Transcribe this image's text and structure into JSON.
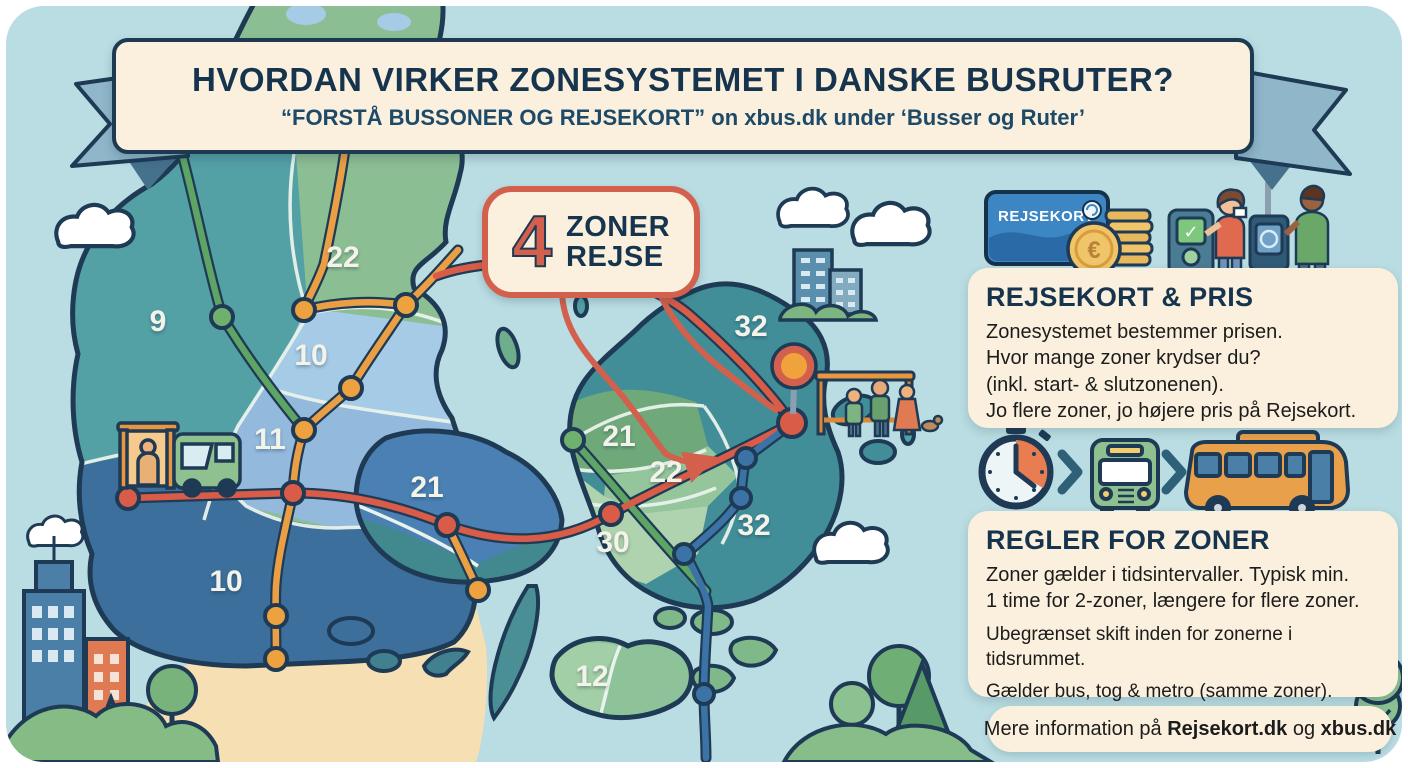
{
  "banner": {
    "title": "HVORDAN VIRKER ZONESYSTEMET I DANSKE BUSRUTER?",
    "subtitle": "“FORSTÅ BUSSONER OG REJSEKORT” on xbus.dk under ‘Busser og Ruter’"
  },
  "callout": {
    "number": "4",
    "line1": "ZONER",
    "line2": "REJSE"
  },
  "map": {
    "zones": [
      {
        "label": "9"
      },
      {
        "label": "22"
      },
      {
        "label": "10"
      },
      {
        "label": "11"
      },
      {
        "label": "10"
      },
      {
        "label": "21"
      },
      {
        "label": "21"
      },
      {
        "label": "22"
      },
      {
        "label": "30"
      },
      {
        "label": "32"
      },
      {
        "label": "32"
      },
      {
        "label": "12"
      }
    ]
  },
  "card": {
    "label": "REJSEKORT"
  },
  "icons": {
    "euro": "€",
    "check": "✓"
  },
  "panels": {
    "pris": {
      "heading": "REJSEKORT & PRIS",
      "lines": [
        "Zonesystemet bestemmer prisen.",
        "Hvor mange zoner krydser du?",
        "(inkl. start- & slutzonenen).",
        "Jo flere zoner, jo højere pris på Rejsekort."
      ]
    },
    "regler": {
      "heading": "REGLER FOR ZONER",
      "lines": [
        "Zoner gælder i tidsintervaller. Typisk min.",
        "1 time for 2-zoner, længere for flere zoner.",
        "Ubegrænset skift inden for zonerne i tidsrummet.",
        "Gælder bus, tog & metro (samme zoner)."
      ]
    }
  },
  "footer": {
    "prefix": "Mere information på ",
    "link1": "Rejsekort.dk",
    "middle": " og ",
    "link2": "xbus.dk"
  },
  "colors": {
    "navy": "#1d3a52",
    "cream": "#faf0dd",
    "red": "#d2604d",
    "orange": "#eb9f44",
    "route_green": "#5ea464",
    "route_blue": "#3c73a6",
    "water": "#b9dde2"
  }
}
